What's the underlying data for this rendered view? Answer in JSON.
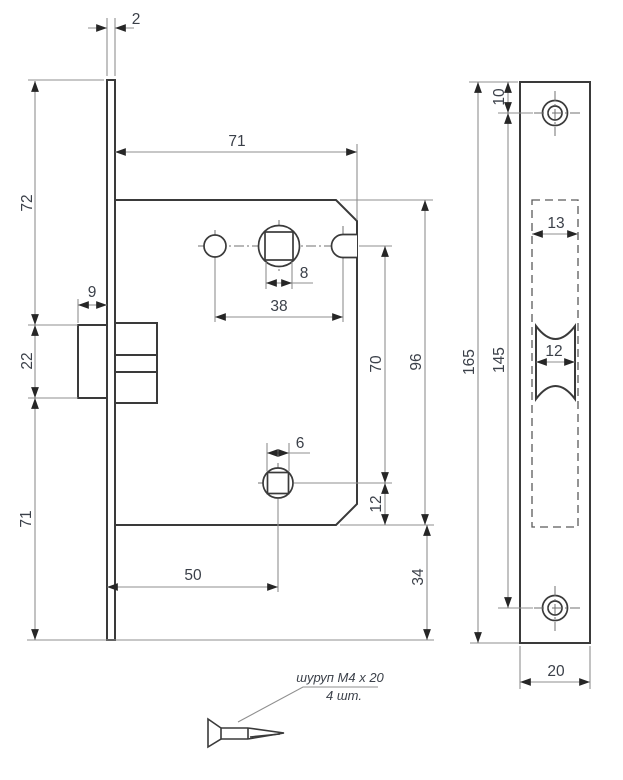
{
  "drawing": {
    "kind": "mortise-lock technical drawing, side view and faceplate front view with screw note"
  },
  "dims": {
    "side": {
      "faceplate_thickness": "2",
      "body_width": "71",
      "top_to_latch": "72",
      "latch_protrusion": "9",
      "latch_height": "22",
      "latch_to_bottom": "71",
      "spindle_square": "8",
      "follower_spacing": "38",
      "spindle_to_privacy": "70",
      "body_height": "96",
      "privacy_square": "6",
      "privacy_to_bottom": "12",
      "backset": "50",
      "below_body": "34"
    },
    "front": {
      "top_to_screw": "10",
      "plate_height": "165",
      "screw_spacing": "145",
      "slot_width": "13",
      "latch_width": "12",
      "plate_width": "20"
    }
  },
  "note": {
    "line1": "шуруп М4 х 20",
    "line2": "4 шт."
  },
  "colors": {
    "outline": "#3a3a3a",
    "dimension_lines": "#8f8f8f",
    "text": "#3b4049",
    "background": "#ffffff"
  }
}
